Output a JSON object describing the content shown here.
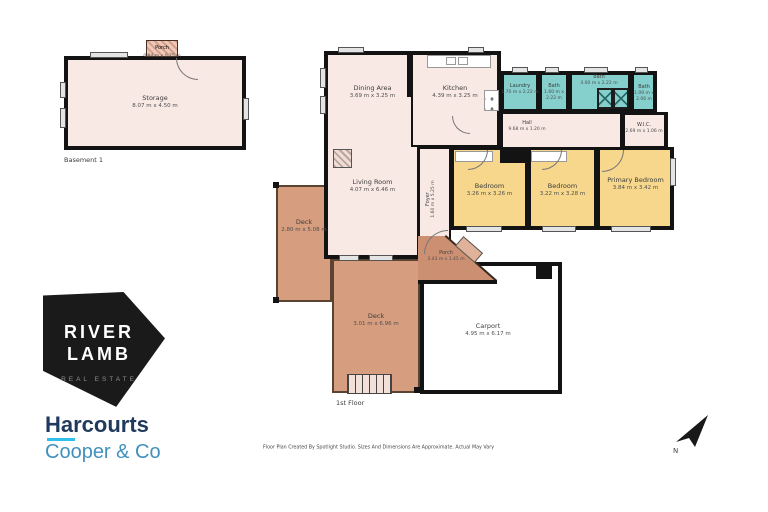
{
  "basement": {
    "floor_label": "Basement 1",
    "porch": {
      "label": "Porch",
      "dims": "0.94 m x 0.75 m"
    },
    "storage": {
      "label": "Storage",
      "dims": "8.07 m x 4.50 m"
    }
  },
  "first_floor": {
    "floor_label": "1st Floor",
    "dining": {
      "label": "Dining Area",
      "dims": "3.69 m x 3.25 m"
    },
    "kitchen": {
      "label": "Kitchen",
      "dims": "4.39 m x 3.25 m"
    },
    "laundry": {
      "label": "Laundry",
      "dims": "1.70 m x 2.22 m"
    },
    "bath1": {
      "label": "Bath",
      "dims": "1.60 m x 2.22 m"
    },
    "bath2": {
      "label": "Bath",
      "dims": "4.00 m x 2.22 m"
    },
    "bath3": {
      "label": "Bath",
      "dims": "1.09 m x 2.06 m"
    },
    "wic": {
      "label": "W.I.C.",
      "dims": "2.69 m x 1.06 m"
    },
    "hall": {
      "label": "Hall",
      "dims": "9.68 m x 1.20 m"
    },
    "foyer": {
      "label": "Foyer",
      "dims": "1.60 m x 5.25 m"
    },
    "living": {
      "label": "Living Room",
      "dims": "4.07 m x 6.46 m"
    },
    "bedroom1": {
      "label": "Bedroom",
      "dims": "3.26 m x 3.26 m"
    },
    "bedroom2": {
      "label": "Bedroom",
      "dims": "3.22 m x 3.28 m"
    },
    "primary": {
      "label": "Primary Bedroom",
      "dims": "3.84 m x 3.42 m"
    },
    "deck_left": {
      "label": "Deck",
      "dims": "2.80 m x 5.08 m"
    },
    "deck_bottom": {
      "label": "Deck",
      "dims": "3.01 m x 6.96 m"
    },
    "porch": {
      "label": "Porch",
      "dims": "3.43 m x 1.45 m"
    },
    "carport": {
      "label": "Carport",
      "dims": "4.95 m x 6.17 m"
    }
  },
  "branding": {
    "riverlamb_line1": "RIVER",
    "riverlamb_line2": "LAMB",
    "riverlamb_line3": "REAL ESTATE",
    "harcourts": "Harcourts",
    "harcourts_sub": "Cooper & Co"
  },
  "footer": {
    "disclaimer": "Floor Plan Created By Spotlight Studio. Sizes And Dimensions Are Approximate. Actual May Vary"
  },
  "compass": {
    "label": "N"
  },
  "colors": {
    "room_fill": "#f8e9e4",
    "wet_fill": "#85cfcc",
    "bedroom_fill": "#f6d78c",
    "deck_fill": "#d79d7f",
    "wall": "#131313",
    "harcourts_navy": "#1f3a5c",
    "harcourts_blue": "#4191bc",
    "accent_cyan": "#2fc0ea"
  }
}
